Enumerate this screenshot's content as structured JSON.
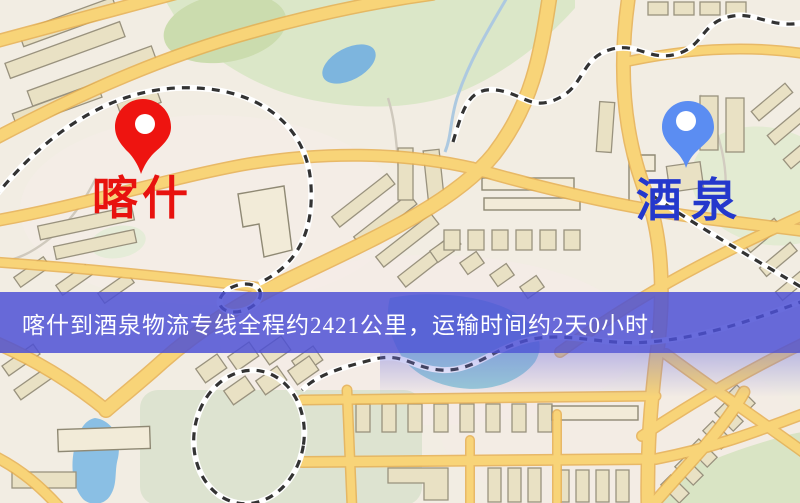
{
  "banner": {
    "text": "喀什到酒泉物流专线全程约2421公里，运输时间约2天0小时.",
    "bg_color": "#4c50d5",
    "text_color": "#ffffff"
  },
  "markers": {
    "origin": {
      "label": "喀什",
      "icon": "red-map-pin-icon",
      "pin_color": "#ee1410",
      "label_color": "#e8120e"
    },
    "destination": {
      "label": "酒泉",
      "icon": "blue-map-pin-icon",
      "pin_color": "#5b8df2",
      "label_color": "#2438cc"
    }
  },
  "map": {
    "colors": {
      "background": "#f2ede3",
      "road": "#f8d478",
      "road_casing": "#e7b052",
      "park": "#dbe7c8",
      "park_dark": "#cbdcae",
      "water": "#8abfe4",
      "water_teal": "#8fc8d4",
      "railway": "#333333",
      "building": "#e9e1c4"
    }
  }
}
